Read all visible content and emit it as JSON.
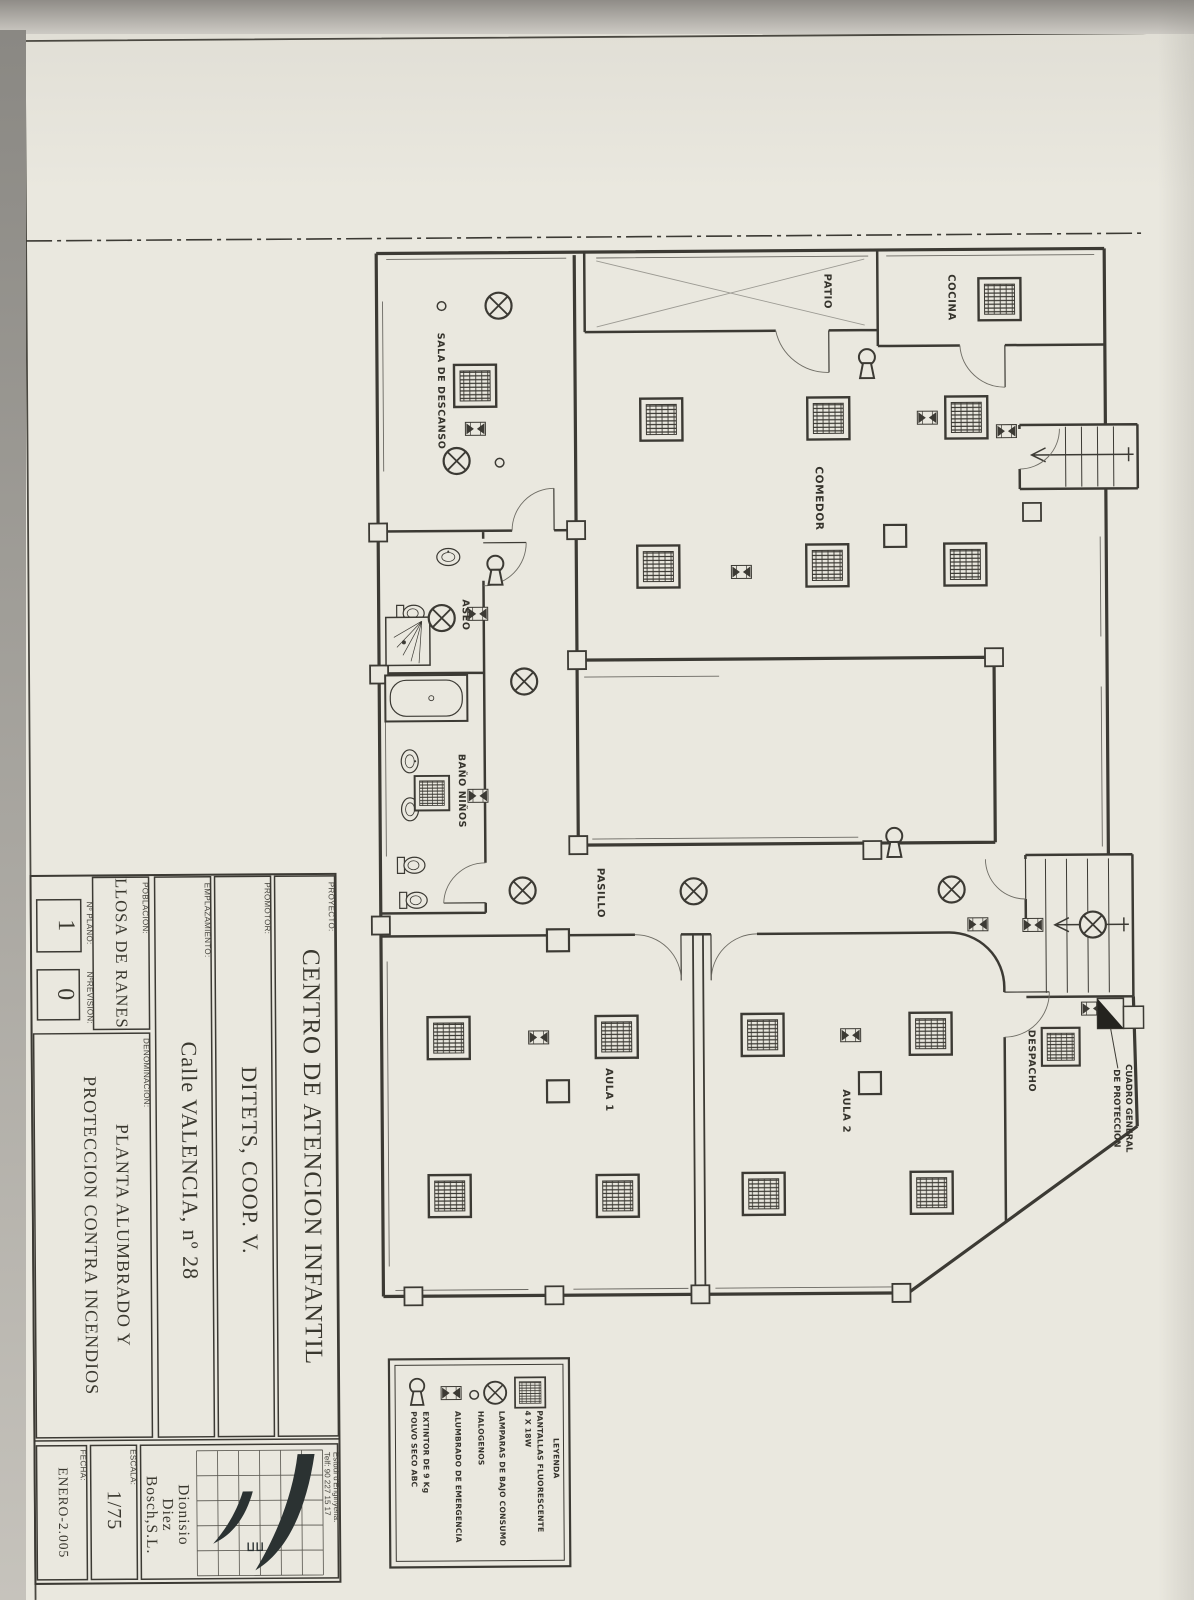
{
  "titleblock": {
    "proyecto_label": "PROYECTO:",
    "proyecto": "CENTRO DE ATENCION INFANTIL",
    "promotor_label": "PROMOTOR:",
    "promotor": "DITETS, COOP. V.",
    "emplazamiento_label": "EMPLAZAMIENTO:",
    "emplazamiento": "Calle VALENCIA, nº 28",
    "poblacion_label": "POBLACION:",
    "poblacion": "LLOSA DE RANES",
    "plano_label": "Nº PLANO:",
    "plano": "1",
    "revision_label": "NºREVISION:",
    "revision": "0",
    "denominacion_label": "DENOMINACION:",
    "denominacion1": "PLANTA ALUMBRADO Y",
    "denominacion2": "PROTECCION CONTRA INCENDIOS",
    "escala_label": "ESCALA:",
    "escala": "1/75",
    "fecha_label": "FECHA:",
    "fecha": "ENERO-2.005",
    "firm1": "Dionisio",
    "firm2": "Diez",
    "firm3": "Bosch,S.L.",
    "studio1": "Estudi d'Enginyeria.",
    "studio2": "Telf: 90 227 15 17"
  },
  "legend": {
    "title": "LEYENDA",
    "items": [
      {
        "name": "fluorescent-panel",
        "line1": "PANTALLAS FLUORESCENTE",
        "line2": "4 X 18W"
      },
      {
        "name": "low-consumption-lamp",
        "line1": "LAMPARAS DE BAJO CONSUMO"
      },
      {
        "name": "halogen",
        "line1": "HALOGENOS"
      },
      {
        "name": "emergency-light",
        "line1": "ALUMBRADO DE EMERGENCIA"
      },
      {
        "name": "extinguisher",
        "line1": "EXTINTOR DE 9 Kg",
        "line2": "POLVO SECO ABC"
      }
    ]
  },
  "plan": {
    "rooms": {
      "patio": "PATIO",
      "cocina": "COCINA",
      "sala": "SALA DE DESCANSO",
      "comedor": "COMEDOR",
      "aseo": "ASEO",
      "bano": "BAÑO NIÑOS",
      "pasillo": "PASILLO",
      "aula1": "AULA 1",
      "aula2": "AULA 2",
      "despacho": "DESPACHO"
    },
    "annotations": {
      "cuadro1": "CUADRO GENERAL",
      "cuadro2": "DE PROTECCION"
    }
  },
  "colors": {
    "paper": "#eae8df",
    "ink": "#3c3a34"
  }
}
